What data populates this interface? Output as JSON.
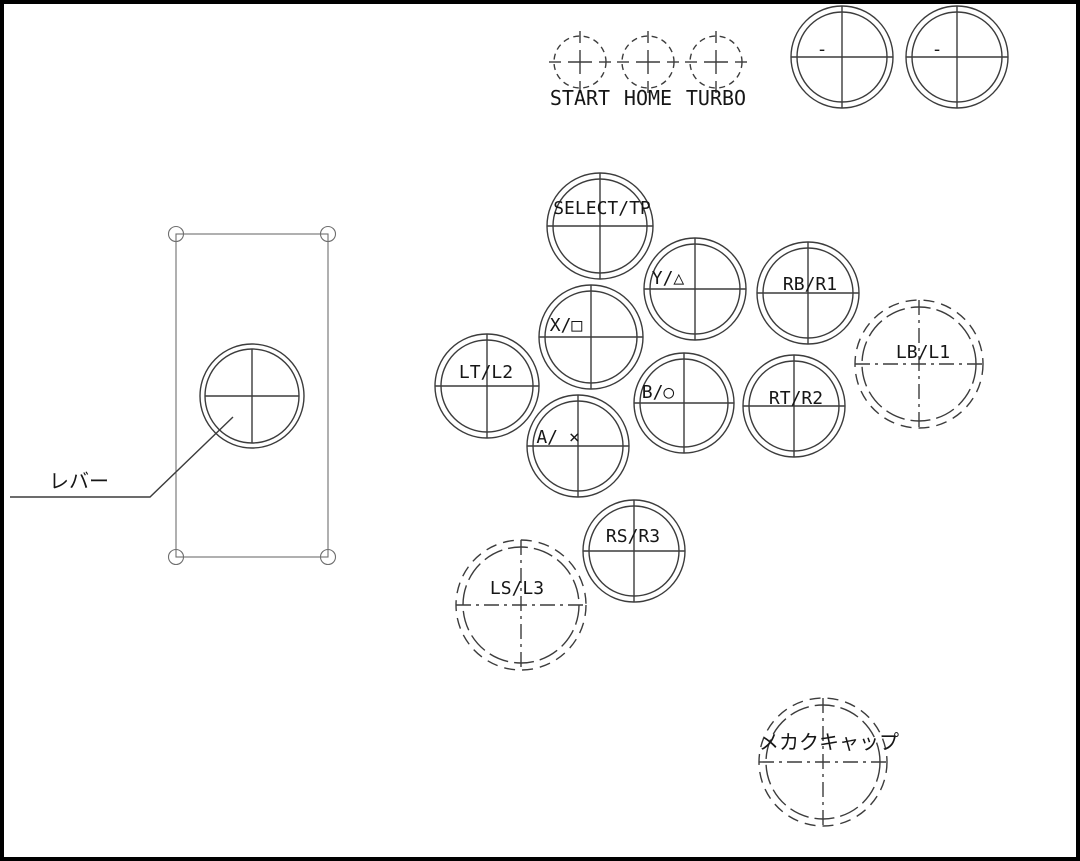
{
  "drawing": {
    "title": "arcade-stick-button-layout-drawing",
    "colors": {
      "background": "#ffffff",
      "border": "#000000",
      "line": "#3c3c3c",
      "text": "#161616"
    },
    "small_buttons": [
      {
        "id": "start",
        "label": "START",
        "cx": 580,
        "cy": 62,
        "r": 26
      },
      {
        "id": "home",
        "label": "HOME",
        "cx": 648,
        "cy": 62,
        "r": 26
      },
      {
        "id": "turbo",
        "label": "TURBO",
        "cx": 716,
        "cy": 62,
        "r": 26
      }
    ],
    "aux_buttons": [
      {
        "id": "aux-left",
        "label": "-",
        "cx": 842,
        "cy": 57,
        "r_outer": 51,
        "r_inner": 45,
        "label_dx": -20,
        "label_dy": -2
      },
      {
        "id": "aux-right",
        "label": "-",
        "cx": 957,
        "cy": 57,
        "r_outer": 51,
        "r_inner": 45,
        "label_dx": -20,
        "label_dy": -2
      }
    ],
    "buttons": [
      {
        "id": "select-tp",
        "label": "SELECT/TP",
        "cx": 600,
        "cy": 226,
        "r_outer": 53,
        "r_inner": 47,
        "style": "solid",
        "label_dx": 2,
        "label_dy": -12,
        "cjk": false
      },
      {
        "id": "y-triangle",
        "label": "Y/△",
        "cx": 695,
        "cy": 289,
        "r_outer": 51,
        "r_inner": 45,
        "style": "solid",
        "label_dx": -27,
        "label_dy": -5,
        "cjk": false
      },
      {
        "id": "rb-r1",
        "label": "RB/R1",
        "cx": 808,
        "cy": 293,
        "r_outer": 51,
        "r_inner": 45,
        "style": "solid",
        "label_dx": 2,
        "label_dy": -3,
        "cjk": false
      },
      {
        "id": "x-square",
        "label": "X/□",
        "cx": 591,
        "cy": 337,
        "r_outer": 52,
        "r_inner": 46,
        "style": "solid",
        "label_dx": -25,
        "label_dy": -6,
        "cjk": false
      },
      {
        "id": "lt-l2",
        "label": "LT/L2",
        "cx": 487,
        "cy": 386,
        "r_outer": 52,
        "r_inner": 46,
        "style": "solid",
        "label_dx": -1,
        "label_dy": -8,
        "cjk": false
      },
      {
        "id": "b-circle",
        "label": "B/○",
        "cx": 684,
        "cy": 403,
        "r_outer": 50,
        "r_inner": 44,
        "style": "solid",
        "label_dx": -26,
        "label_dy": -5,
        "cjk": false
      },
      {
        "id": "rt-r2",
        "label": "RT/R2",
        "cx": 794,
        "cy": 406,
        "r_outer": 51,
        "r_inner": 45,
        "style": "solid",
        "label_dx": 2,
        "label_dy": -2,
        "cjk": false
      },
      {
        "id": "lb-l1",
        "label": "LB/L1",
        "cx": 919,
        "cy": 364,
        "r_outer": 64,
        "r_inner": 57,
        "style": "dashed",
        "label_dx": 4,
        "label_dy": -6,
        "cjk": false
      },
      {
        "id": "a-cross",
        "label": "A/ ×",
        "cx": 578,
        "cy": 446,
        "r_outer": 51,
        "r_inner": 45,
        "style": "solid",
        "label_dx": -20,
        "label_dy": -3,
        "cjk": false
      },
      {
        "id": "rs-r3",
        "label": "RS/R3",
        "cx": 634,
        "cy": 551,
        "r_outer": 51,
        "r_inner": 45,
        "style": "solid",
        "label_dx": -1,
        "label_dy": -9,
        "cjk": false
      },
      {
        "id": "ls-l3",
        "label": "LS/L3",
        "cx": 521,
        "cy": 605,
        "r_outer": 65,
        "r_inner": 58,
        "style": "dashed",
        "label_dx": -4,
        "label_dy": -11,
        "cjk": false
      },
      {
        "id": "mekaku-cap",
        "label": "メカクキャップ",
        "cx": 823,
        "cy": 762,
        "r_outer": 64,
        "r_inner": 57,
        "style": "dashed",
        "label_dx": 6,
        "label_dy": -13,
        "cjk": true
      }
    ],
    "lever": {
      "label": "レバー",
      "plate": {
        "x": 176,
        "y": 234,
        "width": 152,
        "height": 323,
        "corner_hole_r": 7.5
      },
      "circle": {
        "cx": 252,
        "cy": 396,
        "r_outer": 52,
        "r_inner": 47
      },
      "leader_points": "10,497 150,497 233,417",
      "label_x": 79,
      "label_y": 488
    }
  }
}
